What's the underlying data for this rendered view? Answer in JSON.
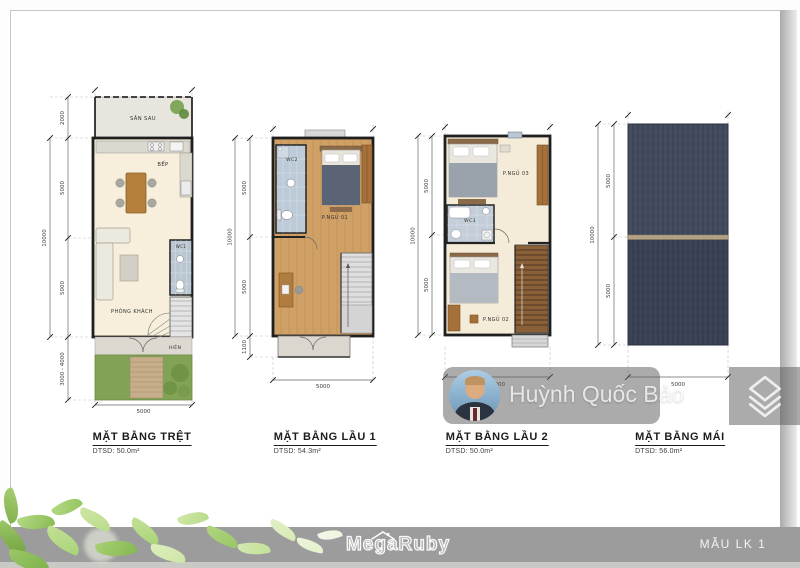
{
  "watermark": {
    "name": "Huỳnh Quốc Bảo"
  },
  "footer": {
    "brand": "MegaRuby",
    "model": "MẪU LK 1"
  },
  "colors": {
    "bar": "#9c9c9c",
    "wood_floor": "#cfa066",
    "cream_floor": "#f6efdc",
    "roof_slate": "#424c5e",
    "garden_green": "#82a355",
    "wc_tile": "#bdcad7"
  },
  "plans": [
    {
      "id": "tret",
      "title": "MẶT BẰNG TRỆT",
      "area": "DTSD: 50.0m²",
      "rooms": {
        "san_sau": "SÂN SAU",
        "bep": "BẾP",
        "wc": "WC1",
        "phong_khach": "PHÒNG KHÁCH",
        "hien": "HIÊN"
      },
      "dims": {
        "left_outer": "10000",
        "left": [
          "2000",
          "5000",
          "5000",
          "3000 - 4000"
        ],
        "bottom": "5000"
      }
    },
    {
      "id": "lau1",
      "title": "MẶT BẰNG LẦU 1",
      "area": "DTSD: 54.3m²",
      "rooms": {
        "wc": "WC2",
        "ngu1": "P.NGỦ 01"
      },
      "dims": {
        "left_outer": "10000",
        "left": [
          "5000",
          "5000",
          "1100"
        ],
        "bottom": "5000"
      }
    },
    {
      "id": "lau2",
      "title": "MẶT BẰNG LẦU 2",
      "area": "DTSD: 50.0m²",
      "rooms": {
        "ngu3": "P.NGỦ 03",
        "wc": "WC3",
        "ngu2": "P.NGỦ 02"
      },
      "dims": {
        "left_outer": "10000",
        "left": [
          "5000",
          "5000"
        ],
        "bottom": "5000"
      }
    },
    {
      "id": "mai",
      "title": "MẶT BẰNG MÁI",
      "area": "DTSD: 56.0m²",
      "rooms": {},
      "dims": {
        "left_outer": "10000",
        "left": [
          "5000",
          "5000"
        ],
        "bottom": "5000"
      }
    }
  ]
}
